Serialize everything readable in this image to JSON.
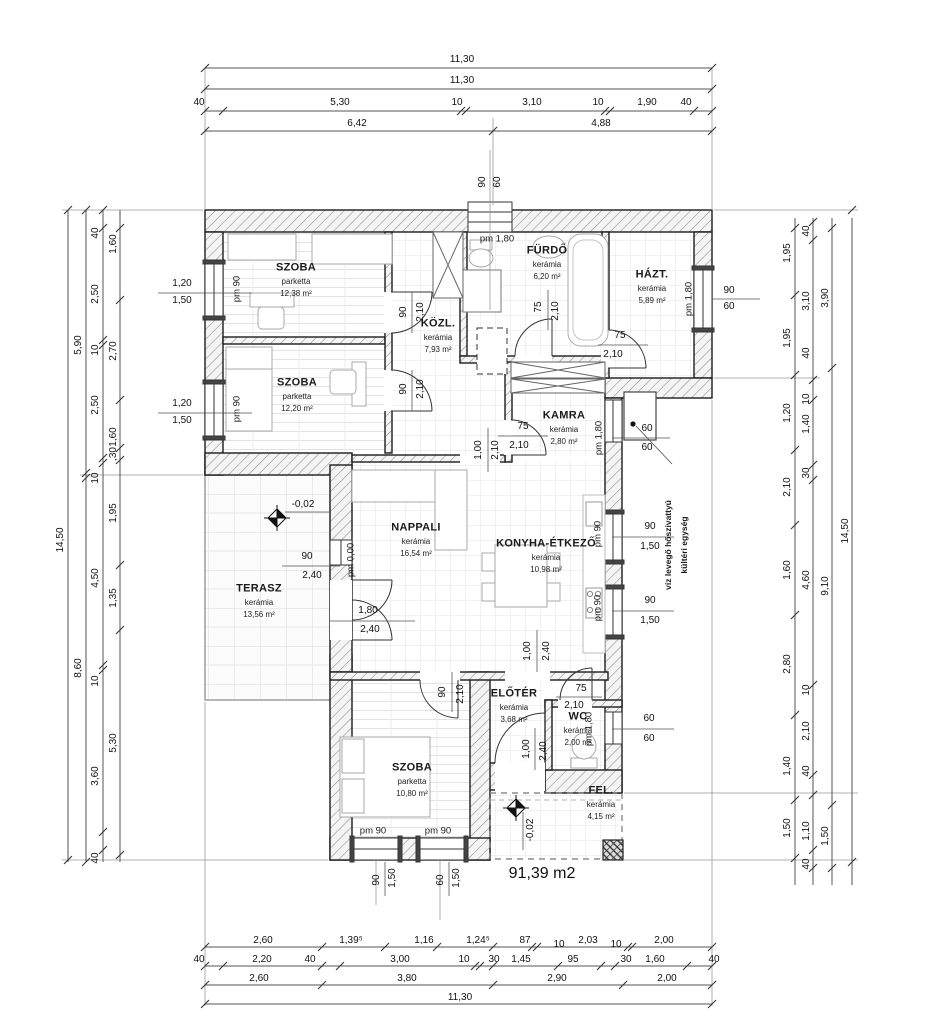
{
  "plan": {
    "total_area": "91,39 m2",
    "rooms": [
      {
        "name": "SZOBA",
        "finish": "parketta",
        "area": "12,38 m²"
      },
      {
        "name": "SZOBA",
        "finish": "parketta",
        "area": "12,20 m²"
      },
      {
        "name": "KÖZL.",
        "finish": "kerámia",
        "area": "7,93 m²"
      },
      {
        "name": "FÜRDŐ",
        "finish": "kerámia",
        "area": "6,20 m²"
      },
      {
        "name": "HÁZT.",
        "finish": "kerámia",
        "area": "5,89 m²"
      },
      {
        "name": "KAMRA",
        "finish": "kerámia",
        "area": "2,80 m²"
      },
      {
        "name": "NAPPALI",
        "finish": "kerámia",
        "area": "16,54 m²"
      },
      {
        "name": "KONYHA-ÉTKEZŐ",
        "finish": "kerámia",
        "area": "10,98 m²"
      },
      {
        "name": "TERASZ",
        "finish": "kerámia",
        "area": "13,56 m²"
      },
      {
        "name": "ELŐTÉR",
        "finish": "kerámia",
        "area": "3,68 m²"
      },
      {
        "name": "WC",
        "finish": "kerámia",
        "area": "2,00 m²"
      },
      {
        "name": "SZOBA",
        "finish": "parketta",
        "area": "10,80 m²"
      },
      {
        "name": "FEL.",
        "finish": "kerámia",
        "area": "4,15 m²"
      }
    ],
    "annotations": [
      {
        "id": "door-szoba1",
        "texts": [
          "90",
          "2,10"
        ]
      },
      {
        "id": "door-szoba2",
        "texts": [
          "90",
          "2,10"
        ]
      },
      {
        "id": "door-furdo",
        "texts": [
          "75",
          "2,10"
        ]
      },
      {
        "id": "door-hazt",
        "texts": [
          "75",
          "2,10"
        ]
      },
      {
        "id": "door-kamra",
        "texts": [
          "75",
          "2,10"
        ]
      },
      {
        "id": "opening-kozl-konyha",
        "texts": [
          "1,00",
          "2,10"
        ]
      },
      {
        "id": "window-terasz",
        "texts": [
          "90",
          "2,40"
        ]
      },
      {
        "id": "door-terasz",
        "texts": [
          "1,80",
          "2,40"
        ]
      },
      {
        "id": "door-szoba3",
        "texts": [
          "90",
          "2,10"
        ]
      },
      {
        "id": "opening-konyha-eloter",
        "texts": [
          "1,00",
          "2,40"
        ]
      },
      {
        "id": "door-wc",
        "texts": [
          "75",
          "2,10"
        ]
      },
      {
        "id": "door-entrance",
        "texts": [
          "1,00",
          "2,40"
        ]
      },
      {
        "id": "window-left-1",
        "texts": [
          "1,20",
          "1,50",
          "pm 90"
        ]
      },
      {
        "id": "window-left-2",
        "texts": [
          "1,20",
          "1,50",
          "pm 90"
        ]
      },
      {
        "id": "window-top",
        "texts": [
          "90",
          "60"
        ]
      },
      {
        "id": "sill-furdo",
        "texts": [
          "pm 1,80"
        ]
      },
      {
        "id": "window-hazt",
        "texts": [
          "90",
          "60",
          "pm 1,80"
        ]
      },
      {
        "id": "window-kamra",
        "texts": [
          "pm 1,80"
        ]
      },
      {
        "id": "window-konyha-1",
        "texts": [
          "90",
          "1,50",
          "pm 90"
        ]
      },
      {
        "id": "window-konyha-2",
        "texts": [
          "90",
          "1,50",
          "pm 90"
        ]
      },
      {
        "id": "window-wc",
        "texts": [
          "60",
          "60",
          "pm 1,80"
        ]
      },
      {
        "id": "window-bottom-1",
        "texts": [
          "pm 90",
          "90",
          "1,50"
        ]
      },
      {
        "id": "window-bottom-2",
        "texts": [
          "pm 90",
          "60",
          "1,50"
        ]
      },
      {
        "id": "heat-pump-size",
        "texts": [
          "60",
          "60"
        ]
      },
      {
        "id": "level-terasz",
        "texts": [
          "-0,02"
        ]
      },
      {
        "id": "level-nappali",
        "texts": [
          "pm 0,00"
        ]
      },
      {
        "id": "level-fel",
        "texts": [
          "-0,02"
        ]
      },
      {
        "id": "heat-pump-note",
        "texts": [
          "víz levegő hőszivattyú",
          "kültéri egység"
        ]
      }
    ]
  },
  "dimensions": {
    "top": [
      [
        "11,30"
      ],
      [
        "11,30"
      ],
      [
        "40",
        "5,30",
        "10",
        "3,10",
        "10",
        "1,90",
        "40"
      ],
      [
        "6,42",
        "4,88"
      ]
    ],
    "bottom": [
      [
        "2,60",
        "1,39⁵",
        "1,16",
        "1,24⁵",
        "87",
        "10",
        "2,03",
        "10",
        "2,00"
      ],
      [
        "40",
        "2,20",
        "40",
        "3,00",
        "10",
        "30",
        "1,45",
        "95",
        "30",
        "1,60",
        "40"
      ],
      [
        "2,60",
        "3,80",
        "2,90",
        "2,00"
      ],
      [
        "11,30"
      ]
    ],
    "left": [
      [
        "14,50"
      ],
      [
        "5,90",
        "8,60"
      ],
      [
        "40",
        "2,50",
        "10",
        "2,50",
        "10",
        "4,50",
        "10",
        "3,60",
        "40"
      ],
      [
        "1,60",
        "2,70",
        "1,60",
        ",30",
        "1,95",
        "1,35",
        "5,30"
      ]
    ],
    "right": [
      [
        "1,95",
        "1,95",
        "1,20",
        "2,10",
        "1,60",
        "2,80",
        "1,40",
        "1,50"
      ],
      [
        "40",
        "3,10",
        "40",
        "10",
        "1,40",
        "30",
        "4,60",
        "10",
        "2,10",
        "40",
        "1,10",
        "40"
      ],
      [
        "3,90",
        "9,10",
        "1,50"
      ],
      [
        "14,50"
      ]
    ]
  }
}
